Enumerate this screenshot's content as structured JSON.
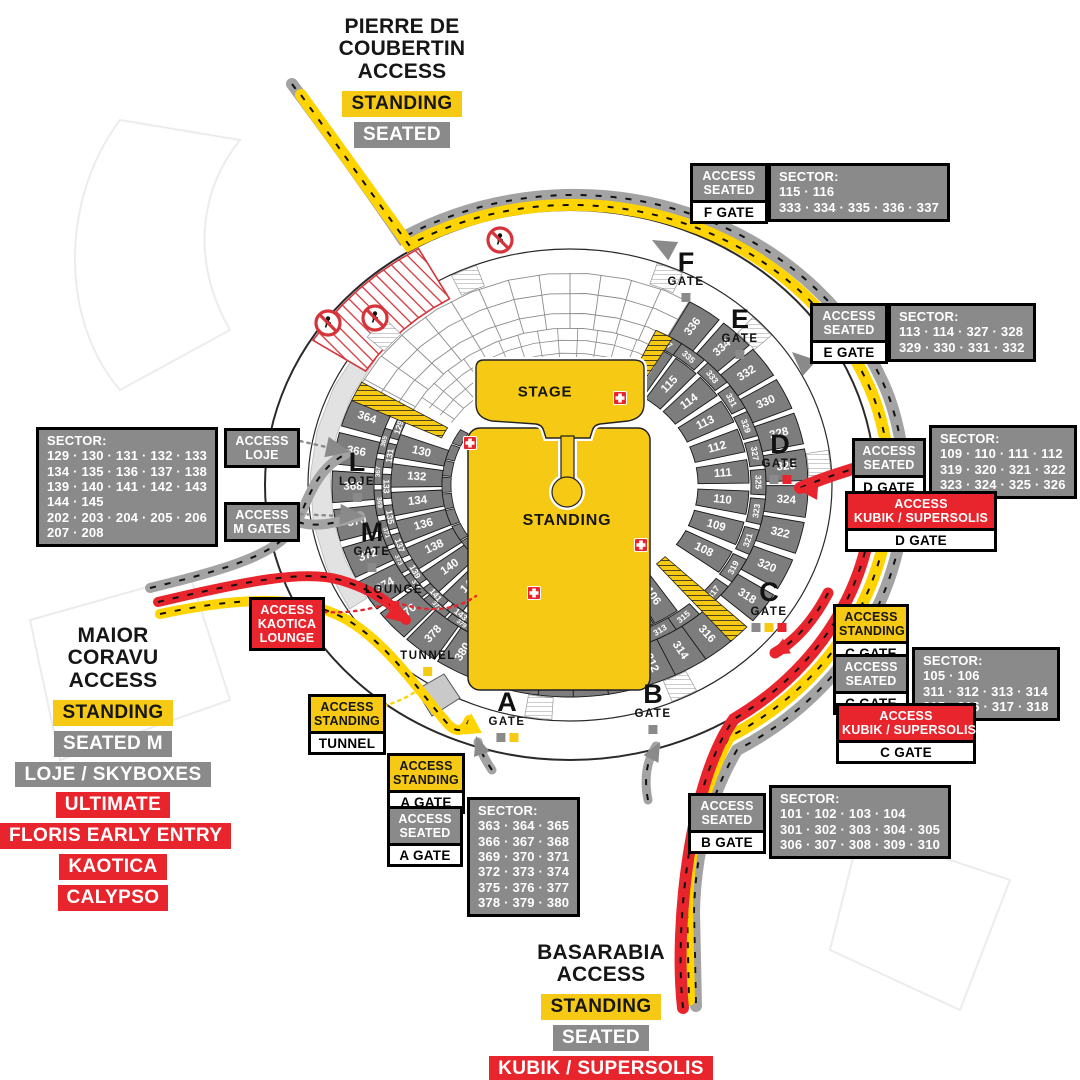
{
  "colors": {
    "yellow": "#F6C915",
    "gray": "#8A8A8A",
    "red": "#E8252D",
    "sector_gray": "#7D7D7D",
    "road_gray": "#A3A3A3",
    "road_yellow": "#FFD400",
    "road_red": "#E8252D",
    "light_band": "#E2E2E2"
  },
  "access_blocks": [
    {
      "id": "pierre",
      "x": 402,
      "y": 16,
      "w": 230,
      "title_lines": [
        "PIERRE DE",
        "COUBERTIN",
        "ACCESS"
      ],
      "badges": [
        {
          "label": "STANDING",
          "style": "yellow"
        },
        {
          "label": "SEATED",
          "style": "gray"
        }
      ]
    },
    {
      "id": "maior",
      "x": 113,
      "y": 625,
      "w": 226,
      "title_lines": [
        "MAIOR",
        "CORAVU",
        "ACCESS"
      ],
      "badges": [
        {
          "label": "STANDING",
          "style": "yellow"
        },
        {
          "label": "SEATED M",
          "style": "gray"
        },
        {
          "label": "LOJE / SKYBOXES",
          "style": "gray"
        },
        {
          "label": "ULTIMATE",
          "style": "red"
        },
        {
          "label": "FLORIS EARLY ENTRY",
          "style": "red"
        },
        {
          "label": "KAOTICA",
          "style": "red"
        },
        {
          "label": "CALYPSO",
          "style": "red"
        }
      ]
    },
    {
      "id": "basarabia",
      "x": 601,
      "y": 942,
      "w": 240,
      "title_lines": [
        "BASARABIA",
        "ACCESS"
      ],
      "badges": [
        {
          "label": "STANDING",
          "style": "yellow"
        },
        {
          "label": "SEATED",
          "style": "gray"
        },
        {
          "label": "KUBIK / SUPERSOLIS",
          "style": "red"
        }
      ]
    }
  ],
  "info_boxes": [
    {
      "id": "f-seated",
      "x": 690,
      "y": 163,
      "w": 78,
      "style": "gray",
      "access_lines": [
        "ACCESS",
        "SEATED"
      ],
      "gate": "F GATE",
      "sector": {
        "x": 768,
        "y": 163,
        "lines": [
          "SECTOR:",
          "115 · 116",
          "333 · 334 · 335 · 336 · 337"
        ]
      }
    },
    {
      "id": "e-seated",
      "x": 810,
      "y": 303,
      "w": 78,
      "style": "gray",
      "access_lines": [
        "ACCESS",
        "SEATED"
      ],
      "gate": "E GATE",
      "sector": {
        "x": 888,
        "y": 303,
        "lines": [
          "SECTOR:",
          "113 · 114 · 327 · 328",
          "329 · 330 · 331 · 332"
        ]
      }
    },
    {
      "id": "d-seated",
      "x": 852,
      "y": 438,
      "w": 74,
      "style": "gray",
      "access_lines": [
        "ACCESS",
        "SEATED"
      ],
      "gate": "D GATE",
      "sector": {
        "x": 929,
        "y": 425,
        "lines": [
          "SECTOR:",
          "109 · 110 · 111 · 112",
          "319 · 320 · 321 · 322",
          "323 · 324 · 325 · 326"
        ]
      }
    },
    {
      "id": "d-kubik",
      "x": 845,
      "y": 491,
      "w": 152,
      "style": "red",
      "access_lines": [
        "ACCESS",
        "KUBIK / SUPERSOLIS"
      ],
      "gate": "D GATE"
    },
    {
      "id": "c-standing",
      "x": 833,
      "y": 604,
      "w": 76,
      "style": "yellow",
      "access_lines": [
        "ACCESS",
        "STANDING"
      ],
      "gate": "C GATE"
    },
    {
      "id": "c-seated",
      "x": 833,
      "y": 654,
      "w": 76,
      "style": "gray",
      "access_lines": [
        "ACCESS",
        "SEATED"
      ],
      "gate": "C GATE",
      "sector": {
        "x": 912,
        "y": 647,
        "lines": [
          "SECTOR:",
          "105 · 106",
          "311 · 312 · 313 · 314",
          "315 · 316 · 317 · 318"
        ]
      }
    },
    {
      "id": "c-kubik",
      "x": 836,
      "y": 703,
      "w": 140,
      "style": "red",
      "access_lines": [
        "ACCESS",
        "KUBIK / SUPERSOLIS"
      ],
      "gate": "C GATE"
    },
    {
      "id": "b-seated",
      "x": 688,
      "y": 793,
      "w": 78,
      "style": "gray",
      "access_lines": [
        "ACCESS",
        "SEATED"
      ],
      "gate": "B GATE",
      "sector": {
        "x": 769,
        "y": 785,
        "lines": [
          "SECTOR:",
          "101 · 102 · 103 · 104",
          "301 · 302 · 303 · 304 · 305",
          "306 · 307 · 308 · 309 · 310"
        ]
      }
    },
    {
      "id": "a-standing",
      "x": 387,
      "y": 753,
      "w": 78,
      "style": "yellow",
      "access_lines": [
        "ACCESS",
        "STANDING"
      ],
      "gate": "A GATE"
    },
    {
      "id": "a-seated",
      "x": 387,
      "y": 806,
      "w": 76,
      "style": "gray",
      "access_lines": [
        "ACCESS",
        "SEATED"
      ],
      "gate": "A GATE",
      "sector": {
        "x": 467,
        "y": 797,
        "lines": [
          "SECTOR:",
          "363 · 364 · 365",
          "366 · 367 · 368",
          "369 · 370 · 371",
          "372 · 373 · 374",
          "375 · 376 · 377",
          "378 · 379 · 380"
        ]
      }
    },
    {
      "id": "loje",
      "x": 224,
      "y": 428,
      "w": 76,
      "style": "gray",
      "access_lines": [
        "ACCESS",
        "LOJE"
      ]
    },
    {
      "id": "m-gates",
      "x": 224,
      "y": 502,
      "w": 76,
      "style": "gray",
      "access_lines": [
        "ACCESS",
        "M GATES"
      ]
    },
    {
      "id": "kaotica-lounge",
      "x": 249,
      "y": 597,
      "w": 76,
      "style": "red",
      "access_lines": [
        "ACCESS",
        "KAOTICA",
        "LOUNGE"
      ]
    },
    {
      "id": "tunnel",
      "x": 308,
      "y": 694,
      "w": 78,
      "style": "yellow",
      "access_lines": [
        "ACCESS",
        "STANDING"
      ],
      "gate": "TUNNEL"
    },
    {
      "id": "west-sectors",
      "x": 36,
      "y": 427,
      "sector_only": true,
      "sector": {
        "x": 36,
        "y": 427,
        "lines": [
          "SECTOR:",
          "129 · 130 · 131 · 132 · 133",
          "134 · 135 · 136 · 137 · 138",
          "139 · 140 · 141 · 142 · 143",
          "144 · 145",
          "202 · 203 · 204 · 205 · 206",
          "207 · 208"
        ]
      }
    }
  ],
  "gate_markers": [
    {
      "id": "f",
      "letter": "F",
      "sub": "GATE",
      "x": 686,
      "y": 250,
      "squares": [
        "gray"
      ]
    },
    {
      "id": "e",
      "letter": "E",
      "sub": "GATE",
      "x": 740,
      "y": 307,
      "squares": [
        "gray"
      ]
    },
    {
      "id": "d",
      "letter": "D",
      "sub": "GATE",
      "x": 780,
      "y": 432,
      "squares": [
        "gray",
        "red"
      ]
    },
    {
      "id": "c",
      "letter": "C",
      "sub": "GATE",
      "x": 769,
      "y": 580,
      "squares": [
        "gray",
        "yellow",
        "red"
      ]
    },
    {
      "id": "a",
      "letter": "A",
      "sub": "GATE",
      "x": 507,
      "y": 690,
      "squares": [
        "gray",
        "yellow"
      ]
    },
    {
      "id": "b",
      "letter": "B",
      "sub": "GATE",
      "x": 653,
      "y": 682,
      "squares": [
        "gray"
      ]
    },
    {
      "id": "l",
      "letter": "L",
      "sub": "LOJE",
      "x": 357,
      "y": 450,
      "squares": [
        "gray"
      ]
    },
    {
      "id": "m",
      "letter": "M",
      "sub": "GATE",
      "x": 372,
      "y": 520,
      "squares": [
        "gray"
      ]
    },
    {
      "id": "lounge",
      "letter": "",
      "sub": "LOUNGE",
      "x": 394,
      "y": 584,
      "squares": [
        "red"
      ]
    },
    {
      "id": "tunnel",
      "letter": "",
      "sub": "TUNNEL",
      "x": 428,
      "y": 650,
      "squares": [
        "yellow"
      ]
    }
  ],
  "floor": {
    "stage_label": "STAGE",
    "standing_label": "STANDING",
    "stage_xy": [
      545,
      392
    ],
    "standing_xy": [
      567,
      521
    ]
  },
  "stadium": {
    "cx": 570,
    "cy": 485,
    "bands": {
      "A": {
        "ro": [
          238,
          212
        ],
        "ri": [
          196,
          172
        ],
        "fs": 11.5
      },
      "B": {
        "ro": [
          196,
          172
        ],
        "ri": [
          181,
          158
        ],
        "fs": 8.5,
        "thin": true
      },
      "BL": {
        "ro": [
          196,
          172
        ],
        "ri": [
          188,
          165
        ],
        "fs": 6.5,
        "thin": true
      },
      "CL": {
        "ro": [
          188,
          165
        ],
        "ri": [
          179,
          157
        ],
        "fs": 8.5,
        "thin": true
      },
      "C": {
        "ro": [
          179,
          157
        ],
        "ri": [
          128,
          107
        ],
        "fs": 11.5
      }
    },
    "sectors": [
      {
        "n": "336",
        "b": "A",
        "t": 304.5
      },
      {
        "n": "334",
        "b": "A",
        "t": 314.5
      },
      {
        "n": "332",
        "b": "A",
        "t": 324.5
      },
      {
        "n": "330",
        "b": "A",
        "t": 334.5
      },
      {
        "n": "328",
        "b": "A",
        "t": 344.5
      },
      {
        "n": "326",
        "b": "A",
        "t": 354.5
      },
      {
        "n": "324",
        "b": "A",
        "t": 4.5
      },
      {
        "n": "322",
        "b": "A",
        "t": 14.5
      },
      {
        "n": "320",
        "b": "A",
        "t": 25
      },
      {
        "n": "318",
        "b": "A",
        "t": 35.5
      },
      {
        "n": "316",
        "b": "A",
        "t": 51
      },
      {
        "n": "314",
        "b": "A",
        "t": 59.5
      },
      {
        "n": "312",
        "b": "A",
        "t": 68
      },
      {
        "n": "310",
        "b": "A",
        "t": 76.5
      },
      {
        "n": "308",
        "b": "A",
        "t": 85
      },
      {
        "n": "306",
        "b": "A",
        "t": 93.5
      },
      {
        "n": "304",
        "b": "A",
        "t": 102
      },
      {
        "n": "302",
        "b": "A",
        "t": 110
      },
      {
        "n": "380",
        "b": "A",
        "t": 119.5
      },
      {
        "n": "378",
        "b": "A",
        "t": 129
      },
      {
        "n": "376",
        "b": "A",
        "t": 138.5
      },
      {
        "n": "374",
        "b": "A",
        "t": 148.5
      },
      {
        "n": "372",
        "b": "A",
        "t": 158.5
      },
      {
        "n": "370",
        "b": "A",
        "t": 169
      },
      {
        "n": "368",
        "b": "A",
        "t": 179.5
      },
      {
        "n": "366",
        "b": "A",
        "t": 190
      },
      {
        "n": "364",
        "b": "A",
        "t": 200.5
      },
      {
        "n": "337",
        "b": "B",
        "t": 300.5
      },
      {
        "n": "335",
        "b": "B",
        "t": 309
      },
      {
        "n": "333",
        "b": "B",
        "t": 319
      },
      {
        "n": "331",
        "b": "B",
        "t": 329
      },
      {
        "n": "329",
        "b": "B",
        "t": 339
      },
      {
        "n": "327",
        "b": "B",
        "t": 349
      },
      {
        "n": "325",
        "b": "B",
        "t": 359
      },
      {
        "n": "323",
        "b": "B",
        "t": 9
      },
      {
        "n": "321",
        "b": "B",
        "t": 19.5
      },
      {
        "n": "319",
        "b": "B",
        "t": 30
      },
      {
        "n": "317",
        "b": "B",
        "t": 40.5
      },
      {
        "n": "315",
        "b": "B",
        "t": 53
      },
      {
        "n": "313",
        "b": "B",
        "t": 61.5
      },
      {
        "n": "311",
        "b": "B",
        "t": 70
      },
      {
        "n": "309",
        "b": "B",
        "t": 78.5
      },
      {
        "n": "307",
        "b": "B",
        "t": 87
      },
      {
        "n": "305",
        "b": "B",
        "t": 95.5
      },
      {
        "n": "303",
        "b": "B",
        "t": 104
      },
      {
        "n": "301",
        "b": "B",
        "t": 112.5
      },
      {
        "n": "379",
        "b": "BL",
        "t": 124.5
      },
      {
        "n": "377",
        "b": "BL",
        "t": 134
      },
      {
        "n": "375",
        "b": "BL",
        "t": 143.5
      },
      {
        "n": "373",
        "b": "BL",
        "t": 153.5
      },
      {
        "n": "371",
        "b": "BL",
        "t": 163.5
      },
      {
        "n": "369",
        "b": "BL",
        "t": 174
      },
      {
        "n": "367",
        "b": "BL",
        "t": 184.5
      },
      {
        "n": "365",
        "b": "BL",
        "t": 195
      },
      {
        "n": "145",
        "b": "CL",
        "t": 116.5
      },
      {
        "n": "143",
        "b": "CL",
        "t": 126.5
      },
      {
        "n": "141",
        "b": "CL",
        "t": 137
      },
      {
        "n": "139",
        "b": "CL",
        "t": 147.5
      },
      {
        "n": "137",
        "b": "CL",
        "t": 158
      },
      {
        "n": "135",
        "b": "CL",
        "t": 168.5
      },
      {
        "n": "133",
        "b": "CL",
        "t": 179.5
      },
      {
        "n": "131",
        "b": "CL",
        "t": 190.5
      },
      {
        "n": "129",
        "b": "CL",
        "t": 201
      },
      {
        "n": "116",
        "b": "C",
        "t": 300.5
      },
      {
        "n": "115",
        "b": "C",
        "t": 310.5
      },
      {
        "n": "114",
        "b": "C",
        "t": 321
      },
      {
        "n": "113",
        "b": "C",
        "t": 332
      },
      {
        "n": "112",
        "b": "C",
        "t": 343.5
      },
      {
        "n": "111",
        "b": "C",
        "t": 355
      },
      {
        "n": "110",
        "b": "C",
        "t": 6.5
      },
      {
        "n": "109",
        "b": "C",
        "t": 18
      },
      {
        "n": "108",
        "b": "C",
        "t": 29.5
      },
      {
        "n": "106",
        "b": "C",
        "t": 57.5
      },
      {
        "n": "105",
        "b": "C",
        "t": 66.5
      },
      {
        "n": "104",
        "b": "C",
        "t": 75.5
      },
      {
        "n": "103",
        "b": "C",
        "t": 84.5
      },
      {
        "n": "101",
        "b": "C",
        "t": 101.5
      },
      {
        "n": "144",
        "b": "C",
        "t": 120.5
      },
      {
        "n": "142",
        "b": "C",
        "t": 131
      },
      {
        "n": "140",
        "b": "C",
        "t": 141.5
      },
      {
        "n": "138",
        "b": "C",
        "t": 152
      },
      {
        "n": "136",
        "b": "C",
        "t": 162.5
      },
      {
        "n": "134",
        "b": "C",
        "t": 173
      },
      {
        "n": "132",
        "b": "C",
        "t": 183.5
      },
      {
        "n": "130",
        "b": "C",
        "t": 194.5
      }
    ],
    "sector_span": 8.6,
    "sliver": {
      "t0": 113,
      "t1": 204,
      "step": 9,
      "ro": [
        128,
        107
      ],
      "ri": [
        119,
        99
      ]
    },
    "yellow_stairs": [
      {
        "t0": 42,
        "t1": 47.5,
        "ro": [
          238,
          212
        ],
        "ri": [
          128,
          107
        ]
      },
      {
        "t0": 91,
        "t1": 96,
        "ro": [
          196,
          172
        ],
        "ri": [
          128,
          107
        ]
      },
      {
        "t0": 203.5,
        "t1": 209,
        "ro": [
          238,
          212
        ],
        "ri": [
          140,
          118
        ]
      },
      {
        "t0": 296,
        "t1": 301.5,
        "ro": [
          196,
          172
        ],
        "ri": [
          145,
          125
        ]
      }
    ],
    "white_stairs": [
      {
        "t0": 289.5,
        "t1": 295.5
      },
      {
        "t0": 314.5,
        "t1": 320.5
      },
      {
        "t0": 351.5,
        "t1": 357.5
      },
      {
        "t0": 61,
        "t1": 67
      },
      {
        "t0": 94,
        "t1": 100
      },
      {
        "t0": 219,
        "t1": 225
      },
      {
        "t0": 243,
        "t1": 249
      }
    ],
    "closed_zone": {
      "t0": 212,
      "t1": 240,
      "ro": [
        303,
        273
      ],
      "ri": [
        241,
        215
      ]
    },
    "medical_crosses": [
      [
        470,
        443
      ],
      [
        620,
        398
      ],
      [
        641,
        545
      ],
      [
        534,
        593
      ]
    ],
    "no_entry_icons": [
      [
        328,
        323
      ],
      [
        375,
        318
      ],
      [
        500,
        240
      ]
    ],
    "tunnel_poly": [
      [
        416,
        690
      ],
      [
        444,
        674
      ],
      [
        460,
        698
      ],
      [
        432,
        716
      ]
    ]
  }
}
